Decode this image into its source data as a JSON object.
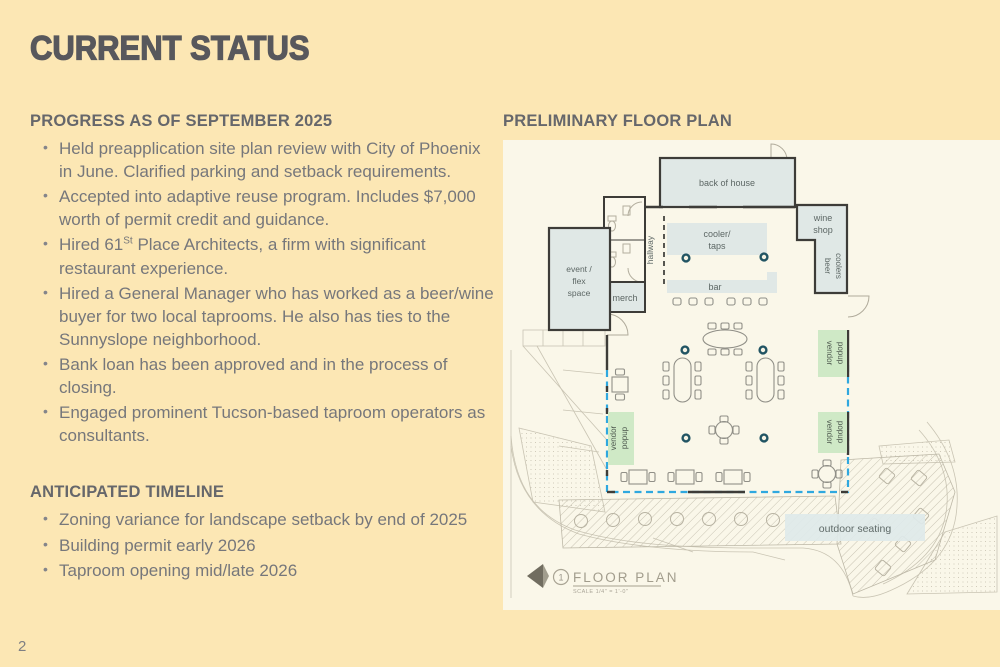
{
  "slide": {
    "title": "CURRENT STATUS",
    "page_number": "2"
  },
  "progress": {
    "heading": "PROGRESS AS OF SEPTEMBER 2025",
    "items": [
      "Held preapplication site plan review with City of Phoenix in June. Clarified parking and setback requirements.",
      "Accepted into adaptive reuse program. Includes $7,000 worth of permit credit and guidance.",
      {
        "prefix": "Hired 61",
        "sup": "St",
        "suffix": " Place Architects, a firm with significant restaurant experience."
      },
      "Hired a General Manager who has worked as a beer/wine buyer for two local taprooms. He also has ties to the Sunnyslope neighborhood.",
      "Bank loan has been approved and in the process of closing.",
      "Engaged prominent Tucson-based taproom operators as consultants."
    ]
  },
  "timeline": {
    "heading": "ANTICIPATED TIMELINE",
    "items": [
      "Zoning variance for landscape setback by end of 2025",
      "Building permit early 2026",
      "Taproom opening mid/late 2026"
    ]
  },
  "floor_plan": {
    "heading": "PRELIMINARY FLOOR PLAN",
    "labels": {
      "back_of_house": "back of house",
      "wine_line1": "wine",
      "wine_line2": "shop",
      "beer_line1": "beer",
      "beer_line2": "coolers",
      "hallway": "hallway",
      "cooler_line1": "cooler/",
      "cooler_line2": "taps",
      "bar": "bar",
      "event_line1": "event /",
      "event_line2": "flex",
      "event_line3": "space",
      "merch": "merch",
      "vendor_line1": "vendor",
      "vendor_line2": "popup",
      "outdoor_seating": "outdoor seating"
    },
    "title_block": {
      "title": "FLOOR PLAN",
      "number": "1",
      "scale": "SCALE  1/4\" = 1'-0\""
    }
  },
  "colors": {
    "background": "#FCE7B4",
    "title_text": "#58585C",
    "heading_text": "#66676B",
    "body_text": "#76777B",
    "panel_background": "#FAF7E9",
    "room_fill": "#E0E8E6",
    "wall": "#3D3C38",
    "vendor_green": "#CFE9C6",
    "setback_dashed_blue": "#2FA8DF",
    "column_teal": "#215463",
    "sketch_gray": "#C9C4B3"
  }
}
